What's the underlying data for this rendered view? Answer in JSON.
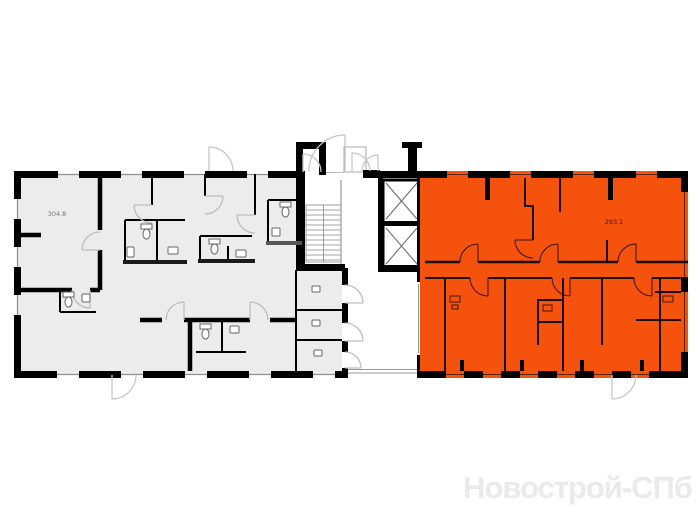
{
  "floor_plan": {
    "units": [
      {
        "id": "left-unit",
        "area_label": "304.8",
        "highlighted": false
      },
      {
        "id": "right-unit",
        "area_label": "293.1",
        "highlighted": true
      }
    ],
    "watermark_text": "Новострой-СПб"
  },
  "colors": {
    "selected_unit": "#F5520D",
    "unselected_unit": "#ECECEC",
    "wall": "#000000",
    "door_arc": "#BDBDBD",
    "watermark": "#EAEAEA",
    "background": "#FFFFFF"
  }
}
